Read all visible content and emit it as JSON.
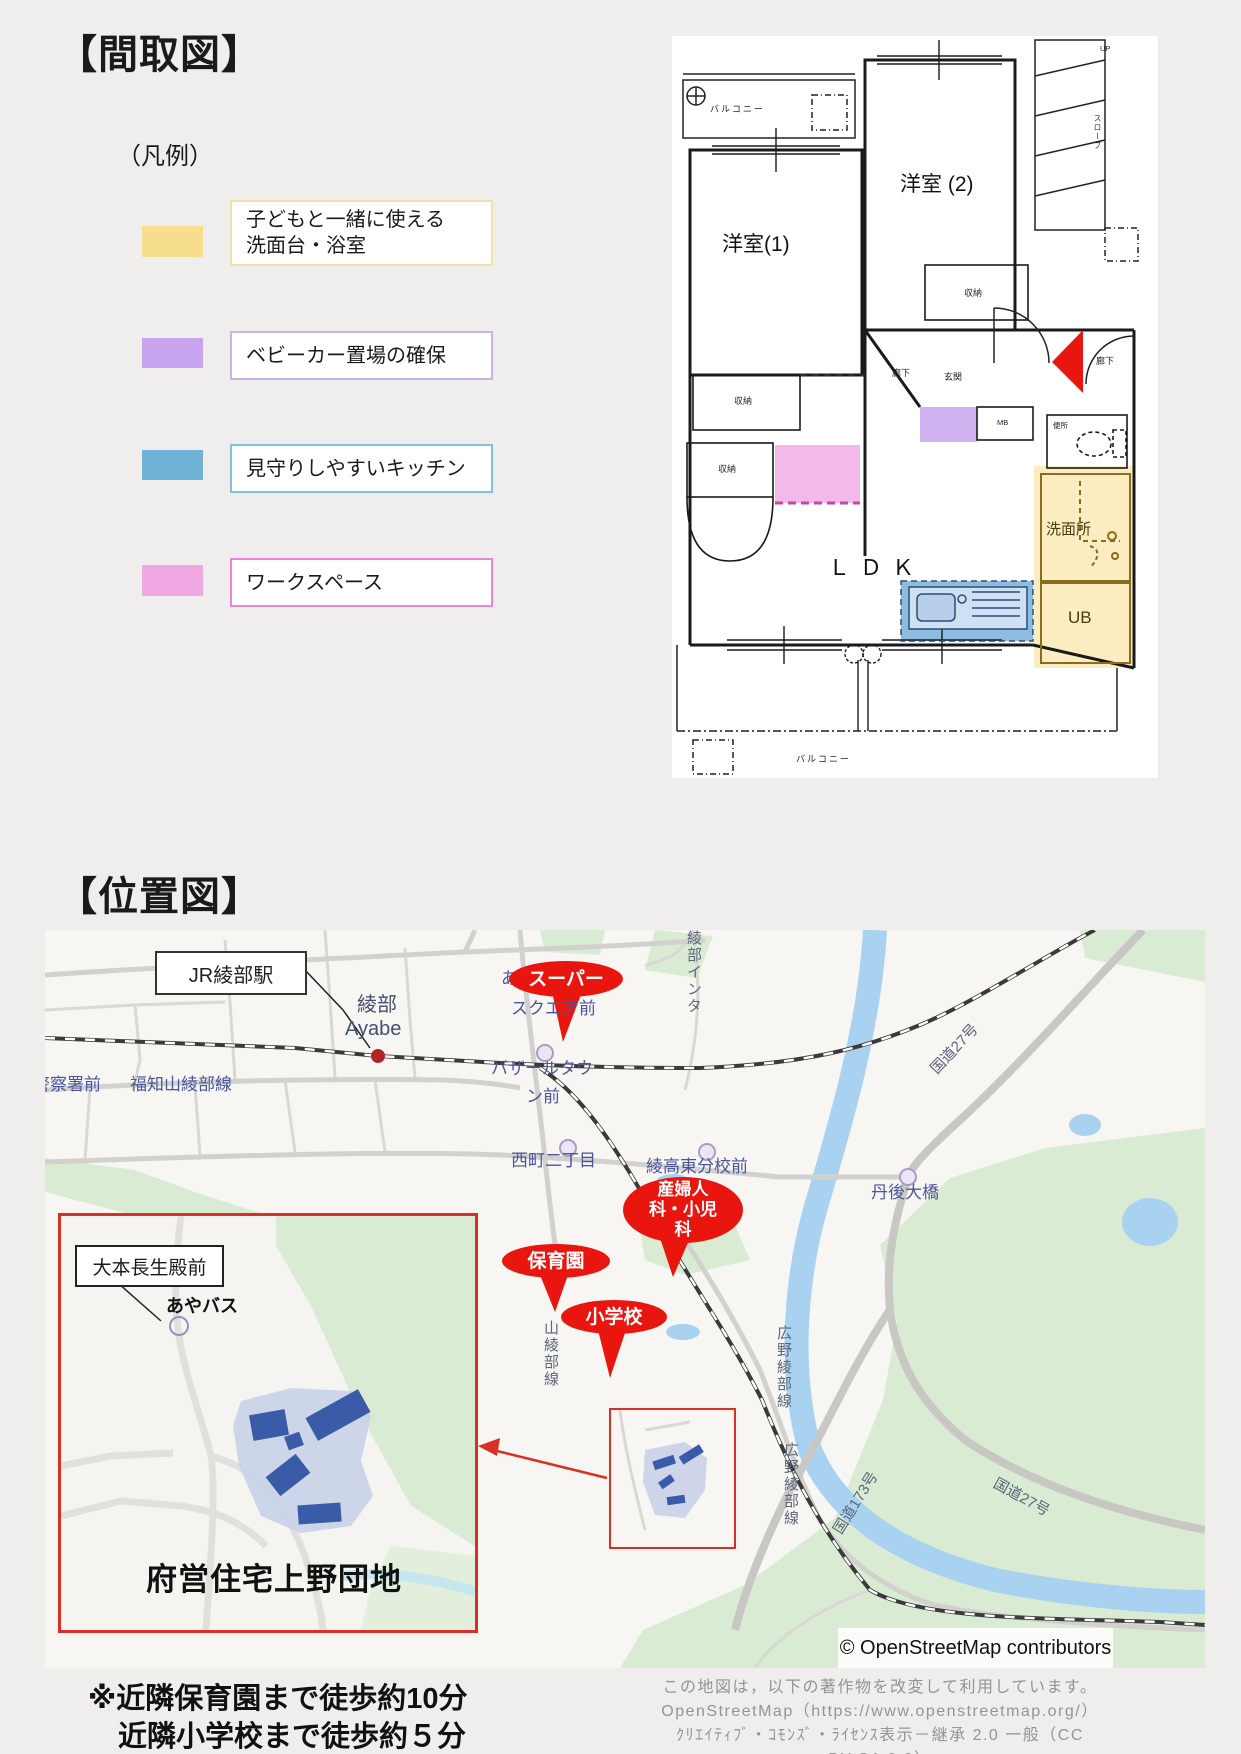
{
  "floorplan": {
    "title": "【間取図】",
    "legend_label": "（凡例）",
    "legend": {
      "items": [
        {
          "label": "子どもと一緒に使える",
          "label2": "洗面台・浴室",
          "swatch": "#f7dd8e",
          "border": "#f3e2a8"
        },
        {
          "label": "ベビーカー置場の確保",
          "label2": "",
          "swatch": "#c8a4ee",
          "border": "#c9b4e9"
        },
        {
          "label": "見守りしやすいキッチン",
          "label2": "",
          "swatch": "#6fb3d9",
          "border": "#82c1de"
        },
        {
          "label": "ワークスペース",
          "label2": "",
          "swatch": "#f0a8e2",
          "border": "#ea84d8"
        }
      ]
    },
    "rooms": {
      "balcony_top": "バルコニー",
      "yoshitsu1": "洋室(1)",
      "yoshitsu2": "洋室 (2)",
      "shuno": "収納",
      "rouka": "廊下",
      "genkan": "玄関",
      "mb": "MB",
      "benjo": "便所",
      "senmenjo": "洗面所",
      "ub": "UB",
      "ldk": "ＬＤＫ",
      "slope": "スロープ",
      "up": "UP",
      "balcony_bottom": "バルコニー"
    }
  },
  "location": {
    "title": "【位置図】",
    "colors": {
      "balloon": "#e8160e",
      "inset_border": "#d93025",
      "rail": "#3a3a3a",
      "river": "#a9d2f1",
      "green": "#d9ecd3"
    },
    "places": {
      "station_box": "JR綾部駅",
      "station_ja": "綾部",
      "station_en": "Ayabe",
      "keisatsu": "警察署前",
      "a_char": "あ",
      "square_mae": "スクエア前",
      "bazaar1": "バザールタウ",
      "bazaar2": "ン前",
      "nishimachi": "西町二丁目",
      "bunko": "綾高東分校前",
      "tango": "丹後大橋"
    },
    "roads": {
      "fukuchiyama": "福知山綾部線",
      "route27a": "国道27号",
      "route27b": "国道27号",
      "route173": "国道173号",
      "hirono1": "広野綾部線",
      "hirono2": "広野綾部線",
      "yamaayabe": "山綾部線",
      "inter": "綾部インタ"
    },
    "balloons": {
      "super": "スーパー",
      "sanfujin": {
        "lines": [
          "産婦人",
          "科・小児",
          "科"
        ]
      },
      "hoikuen": "保育園",
      "shogakko": "小学校"
    },
    "inset": {
      "bus_stop_label": "大本長生殿前",
      "bus_name": "あやバス",
      "estate_name": "府営住宅上野団地"
    },
    "copyright": "© OpenStreetMap contributors",
    "license_lines": [
      "この地図は，以下の著作物を改変して利用しています。",
      "OpenStreetMap（https://www.openstreetmap.org/）",
      "ｸﾘｴｲﾃｨﾌﾞ・ｺﾓﾝｽﾞ・ﾗｲｾﾝｽ表示－継承 2.0 一般（CC BY-SA 2.0）",
      "https://creativecommons.org/licenses/by-sa/2.0/deed.ja"
    ],
    "walk_note_line1": "※近隣保育園まで徒歩約10分",
    "walk_note_line2": "近隣小学校まで徒歩約５分"
  }
}
